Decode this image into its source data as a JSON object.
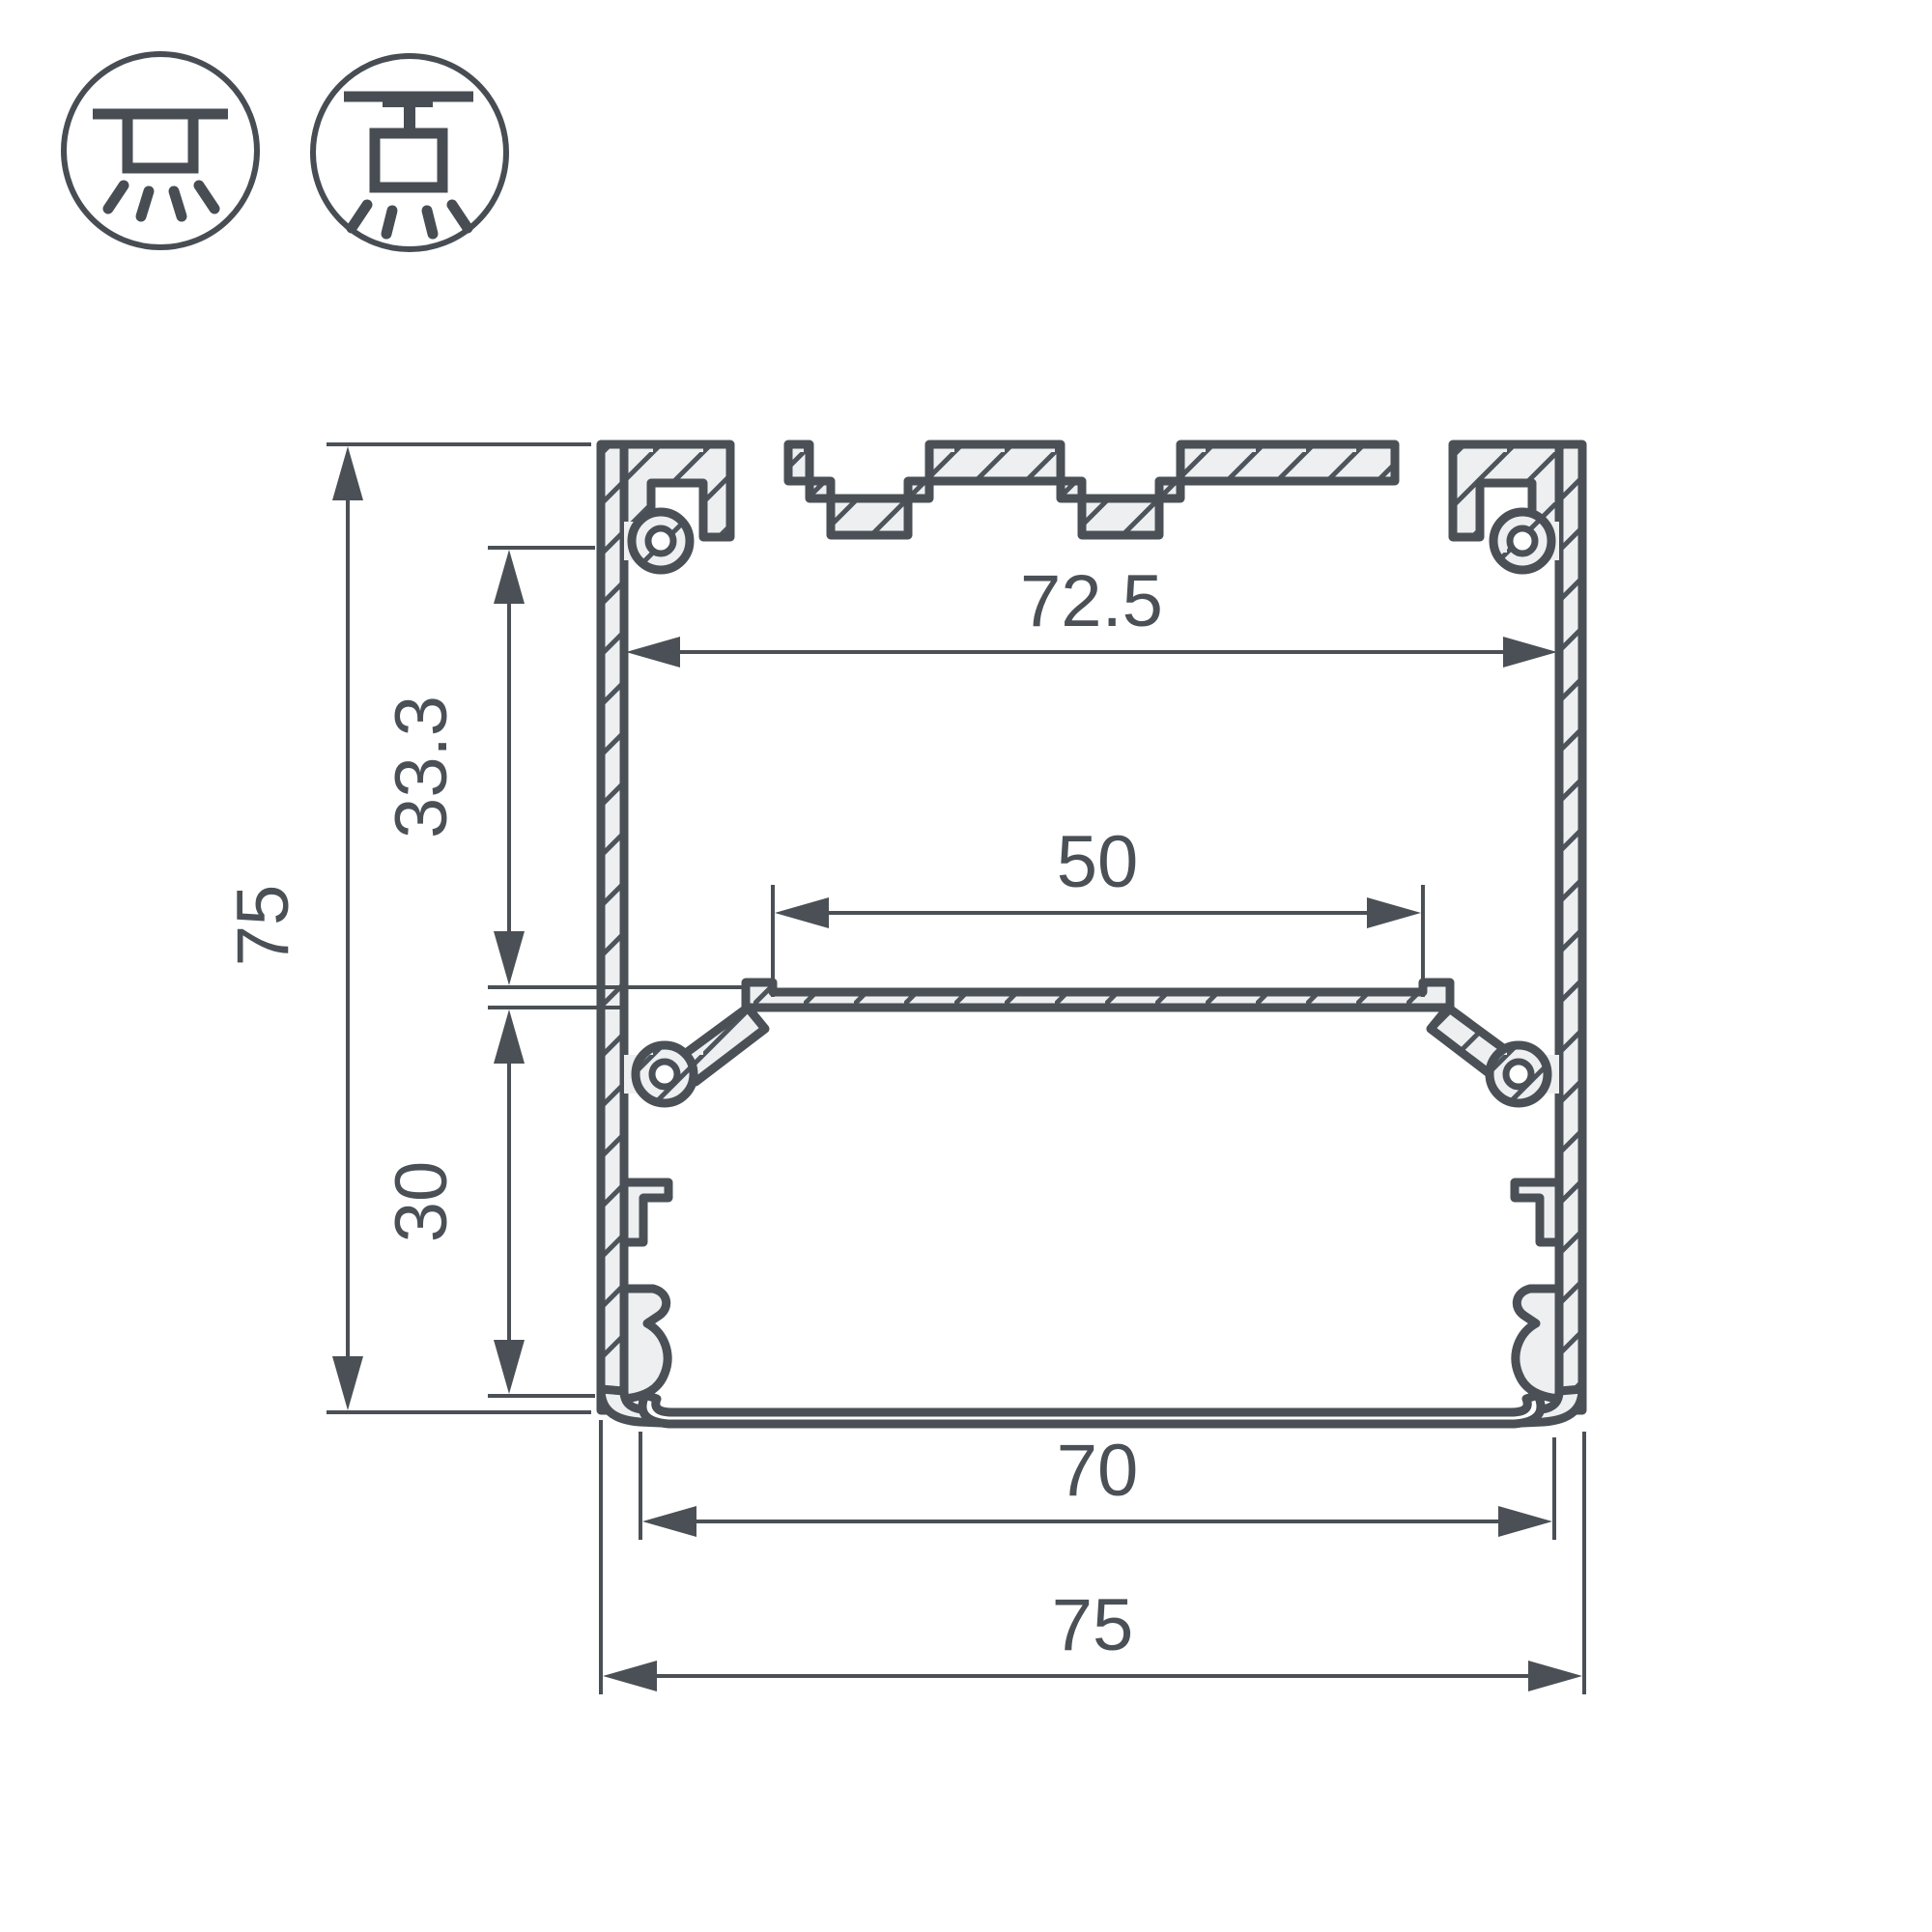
{
  "drawing": {
    "kind": "led-profile-cross-section-technical-drawing"
  },
  "mount_icons": [
    {
      "name": "surface-mount-icon"
    },
    {
      "name": "pendant-mount-icon"
    }
  ],
  "dimensions": {
    "inner_width_top": "72.5",
    "led_strip_width": "50",
    "total_height": "75",
    "upper_height": "33.3",
    "lower_height": "30",
    "inner_width_bottom": "70",
    "total_width": "75"
  },
  "colors": {
    "line": "#4a5056",
    "material_fill": "#edeff1",
    "background": "#ffffff"
  }
}
